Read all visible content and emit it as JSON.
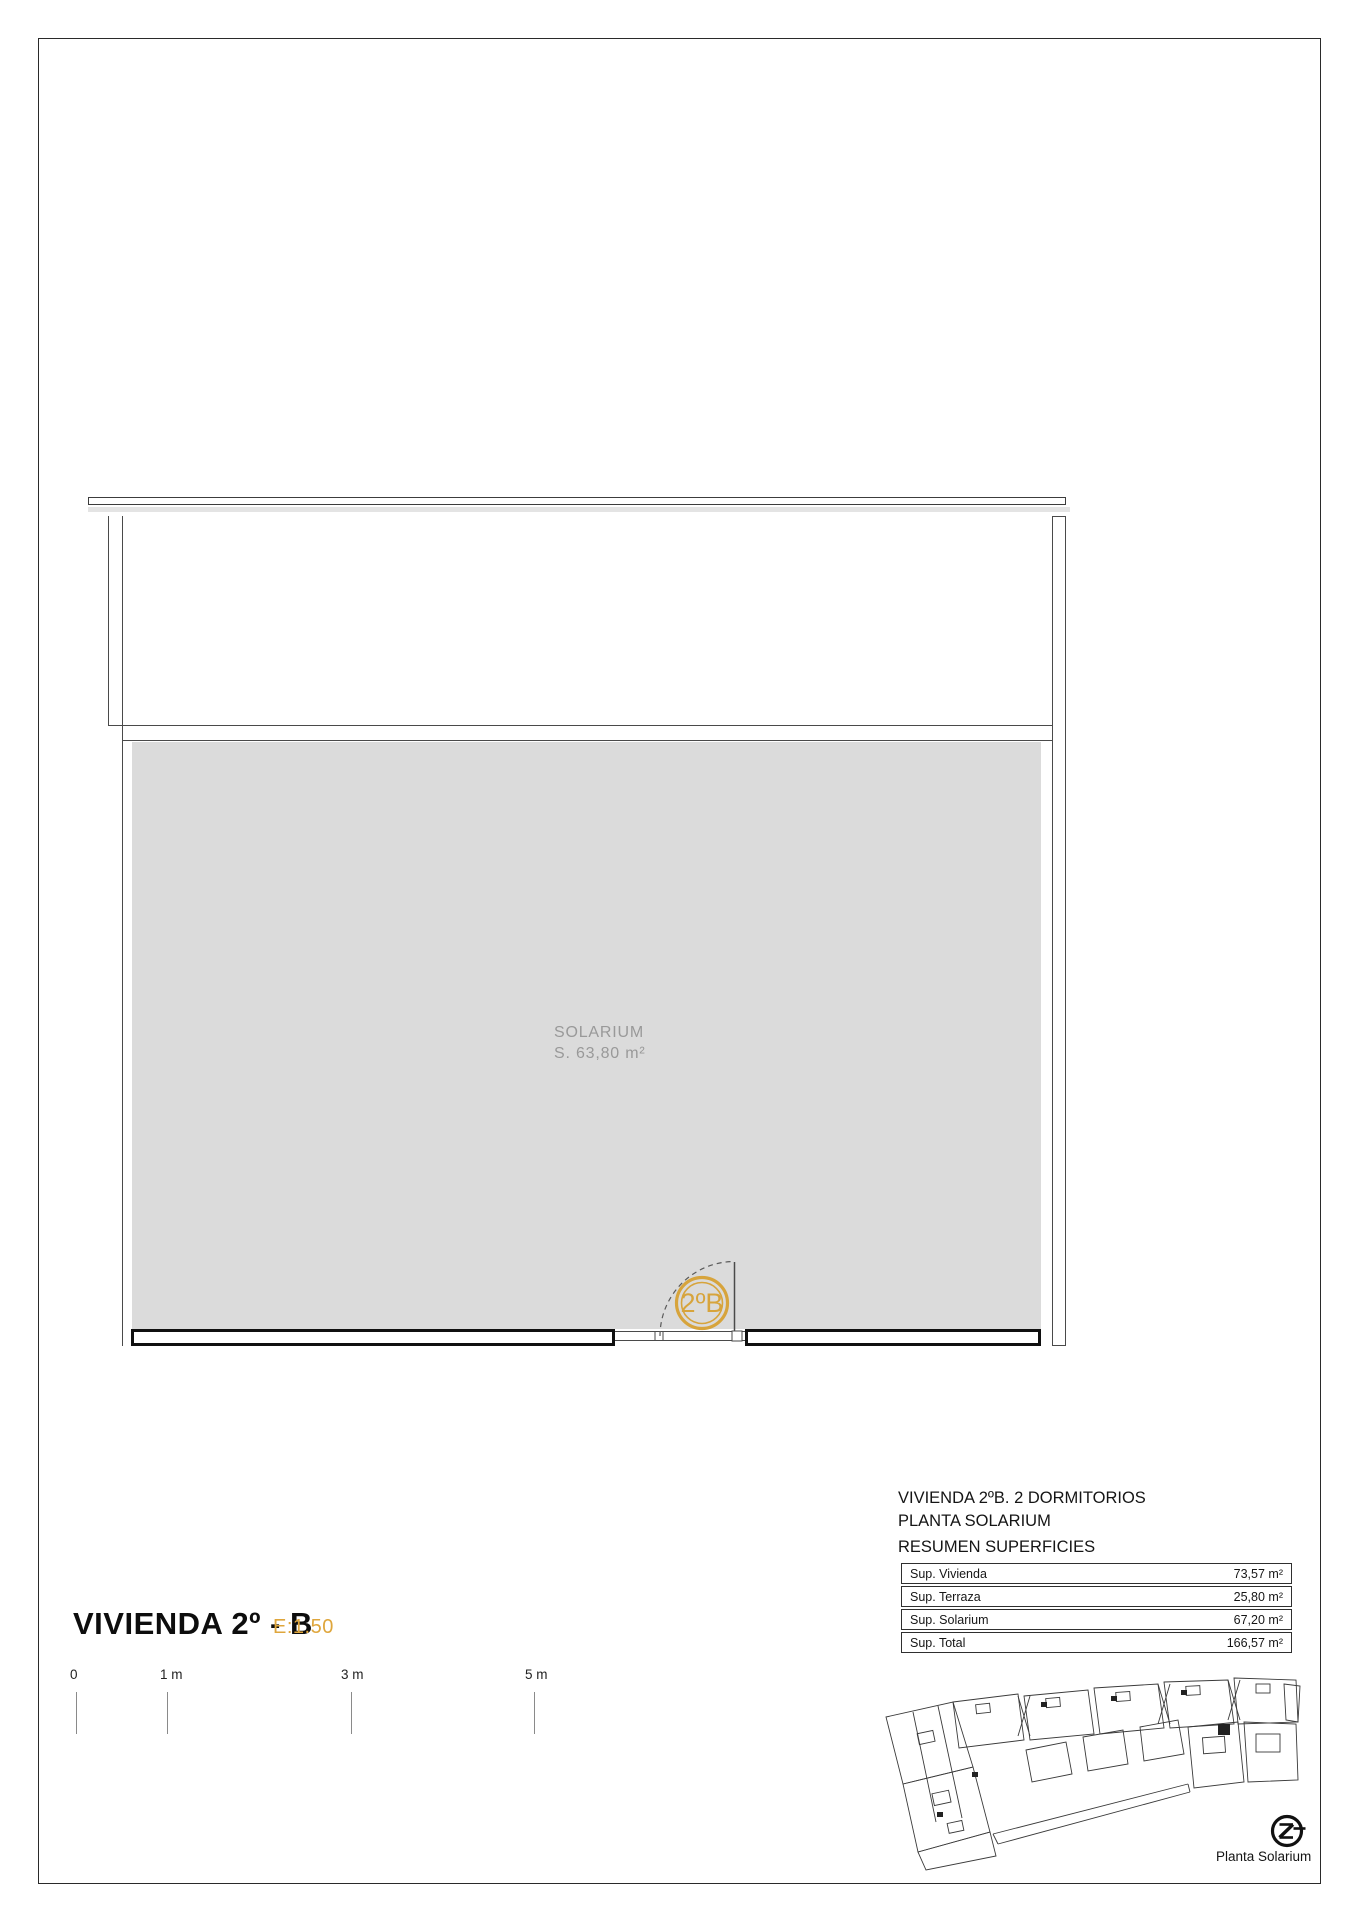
{
  "plan": {
    "room_label": "SOLARIUM",
    "room_area": "S. 63,80 m²",
    "unit_badge": "2ºB"
  },
  "title_block": {
    "title": "VIVIENDA 2º - B",
    "scale": "E:1.50"
  },
  "scale_bar": {
    "labels": [
      "0",
      "1 m",
      "3 m",
      "5 m"
    ]
  },
  "summary": {
    "line1": "VIVIENDA 2ºB. 2 DORMITORIOS",
    "line2": "PLANTA SOLARIUM",
    "line3": "RESUMEN SUPERFICIES",
    "rows": [
      {
        "label": "Sup. Vivienda",
        "value": "73,57 m²"
      },
      {
        "label": "Sup. Terraza",
        "value": "25,80 m²"
      },
      {
        "label": "Sup. Solarium",
        "value": "67,20 m²"
      },
      {
        "label": "Sup. Total",
        "value": "166,57 m²"
      }
    ]
  },
  "key_plan": {
    "caption": "Planta Solarium"
  },
  "colors": {
    "accent_gold": "#D7A43C",
    "plan_gray": "#DBDBDB",
    "line_dark": "#4a4a4a"
  }
}
